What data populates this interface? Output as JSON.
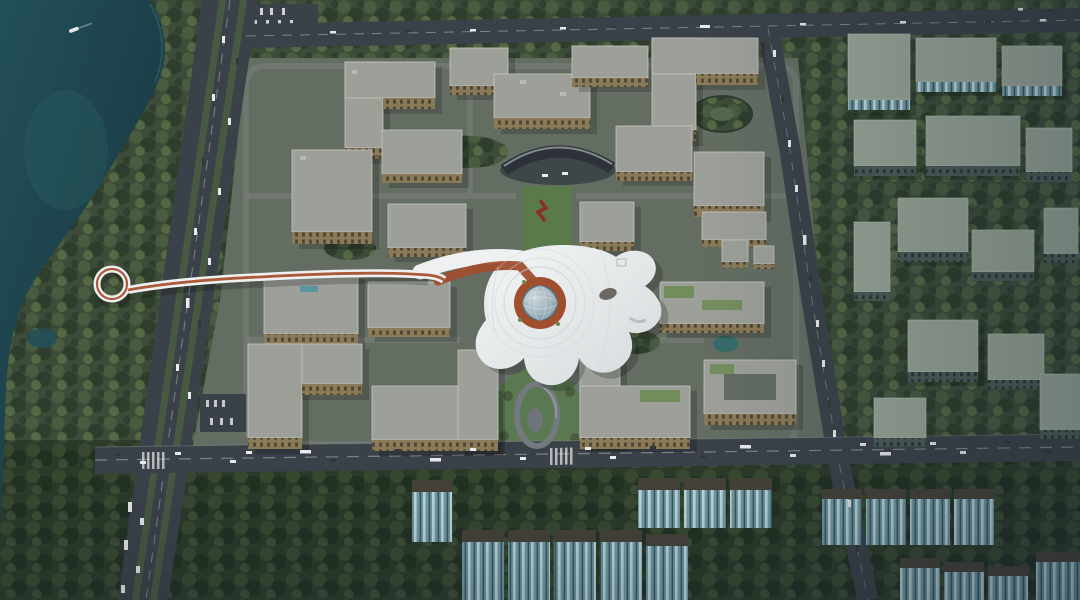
{
  "image": {
    "type": "aerial-architectural-rendering",
    "subject": "bird's-eye rendering of a lakeside residential district: a white organic free-form community center with circular glass dome courtyard, a looping elevated pedestrian bridge crossing a tree-lined boulevard from the lake, symmetric beige apartment blocks, outer rows of glass apartment towers, dense forest belts and busy roads",
    "text_visible": "none"
  },
  "palette": {
    "base": "#445040",
    "forestBase": "#3c4c38",
    "forestDark": "#2e3d2c",
    "forestMid": "#495c40",
    "forestLight": "#5f7549",
    "bfBase": "#2c3a29",
    "bfDark": "#223022",
    "bfMid": "#38492f",
    "lake": "#235059",
    "lakeDeep": "#17323c",
    "lakeEdge": "#2f6b6d",
    "road": "#3b4148",
    "roadMinor": "#4a5055",
    "laneMark": "#aab1b5",
    "ground": "#646d62",
    "path": "#78807a",
    "beigeRoof": "#9d9f99",
    "beigeRoofEdge": "#c6c7c0",
    "beigeWall": "#c9b78c",
    "beigeFace": "#8a7a58",
    "winDark": "#4a4232",
    "white": "#eef0f1",
    "whiteShade": "#ccd1d4",
    "terracotta": "#a04e2e",
    "bridgeRed": "#a6522f",
    "dome": "#7e99a6",
    "domeLight": "#cdd8dc",
    "tealWall": "#729da7",
    "tealLight": "#c2dadd",
    "tealDark": "#3c585e",
    "tealRoof": "#474239",
    "greenRoof": "#9aa698",
    "greenWall": "#4c5c57",
    "greenWin": "#27332f",
    "vehWhite": "#e9ebeb",
    "vehDark": "#33373b",
    "hazeBlue": "#14222e",
    "sculptureRed": "#8f2f24",
    "gardenGreen": "#6a8a4f",
    "grass": "#5a7a4c"
  },
  "scene": {
    "regions": [
      {
        "name": "lake",
        "position": "top-left and left edge",
        "color_key": "lake",
        "features": [
          "single small boat with wake"
        ]
      },
      {
        "name": "shore-forest-belt",
        "position": "left",
        "color_key": "forestMid"
      },
      {
        "name": "boulevard",
        "position": "left, runs top to bottom with slight lean",
        "color_key": "road",
        "features": [
          "tree medians",
          "queued trucks near bottom"
        ]
      },
      {
        "name": "top-road",
        "position": "upper edge, slight downhill to right",
        "color_key": "road",
        "features": [
          "parking lot at left end"
        ]
      },
      {
        "name": "right-road",
        "position": "right third, vertical with slant",
        "color_key": "road",
        "features": [
          "bus and car traffic"
        ]
      },
      {
        "name": "bottom-road",
        "position": "lower third, full width",
        "color_key": "road",
        "features": [
          "heavy two-way traffic",
          "crosswalks"
        ]
      },
      {
        "name": "central-residential-complex",
        "position": "center",
        "color_key": "beigeRoof",
        "building_count": 20,
        "features": [
          "gray roofs",
          "beige facades",
          "entrance gate canopy",
          "central lawn axis",
          "red sculpture",
          "courtyard building",
          "roof gardens"
        ]
      },
      {
        "name": "community-center",
        "position": "center",
        "color_key": "white",
        "features": [
          "organic blob roof",
          "circular void with glass dome",
          "terracotta ring plaza",
          "oval skylight"
        ]
      },
      {
        "name": "pedestrian-bridge",
        "position": "from lake across boulevard into community center",
        "color_key": "white",
        "features": [
          "loop terminus near shore",
          "terracotta running track stripe"
        ]
      },
      {
        "name": "spiral-ramp-garden",
        "position": "south of community center",
        "color_key": "path"
      },
      {
        "name": "east-apartment-rows",
        "position": "right side",
        "color_key": "greenRoof",
        "building_count": 14
      },
      {
        "name": "south-tower-rows",
        "position": "bottom band in forest",
        "color_key": "tealWall",
        "building_count": 14
      }
    ],
    "lighting": "sun from left; long shadows to the right; right side and bottom under darker haze"
  }
}
